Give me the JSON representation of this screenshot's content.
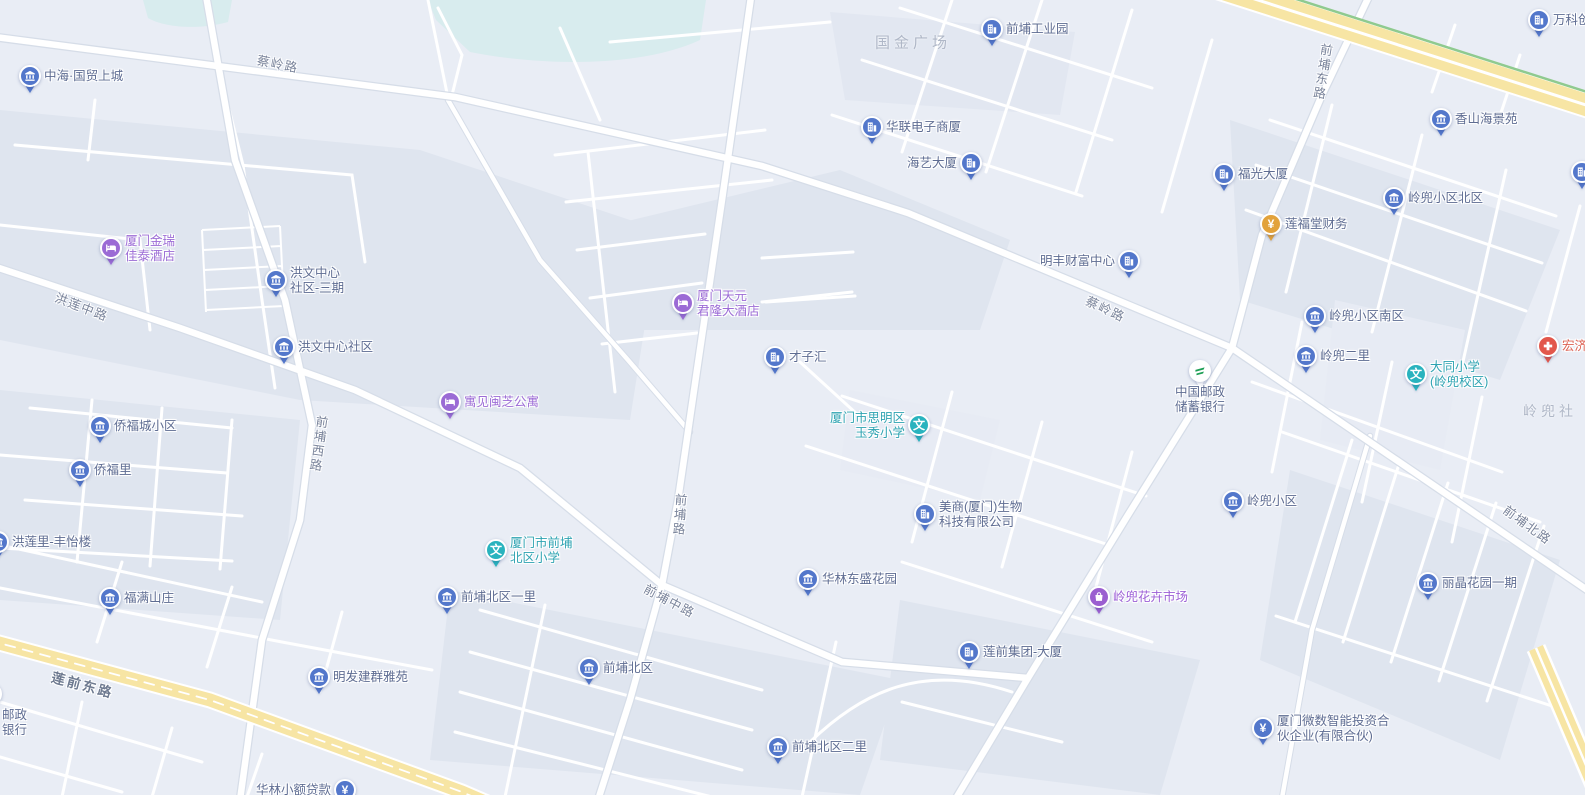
{
  "map": {
    "colors": {
      "background": "#E9EDF5",
      "block": "#DFE5EF",
      "block_light": "#E7EBF4",
      "water": "#D8ECEE",
      "road_fill": "#FFFFFF",
      "road_casing": "#D6DDE8",
      "highway_fill": "#F7E5A4",
      "highway_green": "#8FCA8F",
      "pin_blue": "#5377CB",
      "pin_teal": "#29B3BE",
      "pin_purple": "#9B6BD5",
      "pin_gold": "#E2A23B",
      "pin_red": "#E2574C",
      "post_green": "#1C9E54"
    },
    "poi_types": {
      "community": {
        "color": "#5377CB",
        "label_color": "#5E6C92",
        "icon": "estate-icon"
      },
      "office": {
        "color": "#5377CB",
        "label_color": "#5E6C92",
        "icon": "office-building-icon"
      },
      "school": {
        "color": "#29B3BE",
        "label_color": "#2EA3B2",
        "icon": "school-icon",
        "glyph_char": "文"
      },
      "hotel": {
        "color": "#9B6BD5",
        "label_color": "#9C6CD6",
        "icon": "hotel-bed-icon"
      },
      "market": {
        "color": "#9B5FD0",
        "label_color": "#9C5FD6",
        "icon": "shopping-bag-icon"
      },
      "finance": {
        "color": "#5377CB",
        "label_color": "#5E6C92",
        "icon": "yuan-icon",
        "glyph_char": "¥"
      },
      "finance_gold": {
        "color": "#E2A23B",
        "label_color": "#5E6C92",
        "icon": "yuan-icon",
        "glyph_char": "¥"
      },
      "hospital": {
        "color": "#E2574C",
        "label_color": "#DD6152",
        "icon": "medical-cross-icon"
      },
      "post": {
        "color": "#FFFFFF",
        "label_color": "#5E6C92",
        "icon": "china-post-icon"
      }
    },
    "pois": [
      {
        "type": "community",
        "x": 30,
        "y": 76,
        "side": "right",
        "lines": [
          "中海·国贸上城"
        ]
      },
      {
        "type": "community",
        "x": 276,
        "y": 280,
        "side": "right",
        "lines": [
          "洪文中心",
          "社区-三期"
        ]
      },
      {
        "type": "community",
        "x": 284,
        "y": 347,
        "side": "right",
        "lines": [
          "洪文中心社区"
        ]
      },
      {
        "type": "community",
        "x": 100,
        "y": 426,
        "side": "right",
        "lines": [
          "侨福城小区"
        ]
      },
      {
        "type": "community",
        "x": 80,
        "y": 470,
        "side": "right",
        "lines": [
          "侨福里"
        ]
      },
      {
        "type": "community",
        "x": -2,
        "y": 542,
        "side": "right",
        "lines": [
          "洪莲里-丰怡楼"
        ]
      },
      {
        "type": "community",
        "x": 110,
        "y": 598,
        "side": "right",
        "lines": [
          "福满山庄"
        ]
      },
      {
        "type": "community",
        "x": 447,
        "y": 597,
        "side": "right",
        "lines": [
          "前埔北区一里"
        ]
      },
      {
        "type": "community",
        "x": 589,
        "y": 668,
        "side": "right",
        "lines": [
          "前埔北区"
        ]
      },
      {
        "type": "community",
        "x": 778,
        "y": 747,
        "side": "right",
        "lines": [
          "前埔北区二里"
        ]
      },
      {
        "type": "community",
        "x": 808,
        "y": 579,
        "side": "right",
        "lines": [
          "华林东盛花园"
        ]
      },
      {
        "type": "community",
        "x": 319,
        "y": 677,
        "side": "right",
        "lines": [
          "明发建群雅苑"
        ]
      },
      {
        "type": "community",
        "x": 1441,
        "y": 119,
        "side": "right",
        "lines": [
          "香山海景苑"
        ]
      },
      {
        "type": "community",
        "x": 1394,
        "y": 198,
        "side": "right",
        "lines": [
          "岭兜小区北区"
        ]
      },
      {
        "type": "community",
        "x": 1315,
        "y": 316,
        "side": "right",
        "lines": [
          "岭兜小区南区"
        ]
      },
      {
        "type": "community",
        "x": 1306,
        "y": 356,
        "side": "right",
        "lines": [
          "岭兜二里"
        ]
      },
      {
        "type": "community",
        "x": 1233,
        "y": 501,
        "side": "right",
        "lines": [
          "岭兜小区"
        ]
      },
      {
        "type": "community",
        "x": 1428,
        "y": 583,
        "side": "right",
        "lines": [
          "丽晶花园一期"
        ]
      },
      {
        "type": "office",
        "x": 992,
        "y": 29,
        "side": "right",
        "lines": [
          "前埔工业园"
        ]
      },
      {
        "type": "office",
        "x": 872,
        "y": 127,
        "side": "right",
        "lines": [
          "华联电子商厦"
        ]
      },
      {
        "type": "office",
        "x": 971,
        "y": 163,
        "side": "left",
        "lines": [
          "海艺大厦"
        ]
      },
      {
        "type": "office",
        "x": 1224,
        "y": 174,
        "side": "right",
        "lines": [
          "福光大厦"
        ]
      },
      {
        "type": "office",
        "x": 1129,
        "y": 261,
        "side": "left",
        "lines": [
          "明丰财富中心"
        ]
      },
      {
        "type": "office",
        "x": 775,
        "y": 357,
        "side": "right",
        "lines": [
          "才子汇"
        ]
      },
      {
        "type": "office",
        "x": 925,
        "y": 514,
        "side": "right",
        "lines": [
          "美商(厦门)生物",
          "科技有限公司"
        ]
      },
      {
        "type": "office",
        "x": 969,
        "y": 652,
        "side": "right",
        "lines": [
          "莲前集团-大厦"
        ]
      },
      {
        "type": "office",
        "x": 1539,
        "y": 20,
        "side": "right",
        "lines": [
          "万科创"
        ]
      },
      {
        "type": "office",
        "x": 1582,
        "y": 172,
        "side": "right",
        "lines": []
      },
      {
        "type": "school",
        "x": 919,
        "y": 425,
        "side": "left",
        "lines": [
          "厦门市思明区",
          "玉秀小学"
        ]
      },
      {
        "type": "school",
        "x": 496,
        "y": 550,
        "side": "right",
        "lines": [
          "厦门市前埔",
          "北区小学"
        ]
      },
      {
        "type": "school",
        "x": 1416,
        "y": 374,
        "side": "right",
        "lines": [
          "大同小学",
          "(岭兜校区)"
        ]
      },
      {
        "type": "hotel",
        "x": 111,
        "y": 248,
        "side": "right",
        "lines": [
          "厦门金瑞",
          "佳泰酒店"
        ]
      },
      {
        "type": "hotel",
        "x": 683,
        "y": 303,
        "side": "right",
        "lines": [
          "厦门天元",
          "君隆大酒店"
        ]
      },
      {
        "type": "hotel",
        "x": 450,
        "y": 402,
        "side": "right",
        "lines": [
          "寓见闽芝公寓"
        ]
      },
      {
        "type": "market",
        "x": 1099,
        "y": 597,
        "side": "right",
        "lines": [
          "岭兜花卉市场"
        ]
      },
      {
        "type": "finance_gold",
        "x": 1271,
        "y": 224,
        "side": "right",
        "lines": [
          "莲福堂财务"
        ]
      },
      {
        "type": "finance",
        "x": 1263,
        "y": 728,
        "side": "right",
        "lines": [
          "厦门微数智能投资合",
          "伙企业(有限合伙)"
        ]
      },
      {
        "type": "finance",
        "x": 345,
        "y": 790,
        "side": "left",
        "lines": [
          "华林小额贷款"
        ]
      },
      {
        "type": "post",
        "x": 1200,
        "y": 371,
        "side": "below",
        "lines": [
          "中国邮政",
          "储蓄银行"
        ]
      },
      {
        "type": "post",
        "x": -9,
        "y": 694,
        "side": "below-left",
        "lines": [
          "邮政",
          "银行"
        ]
      },
      {
        "type": "hospital",
        "x": 1548,
        "y": 346,
        "side": "right",
        "lines": [
          "宏济"
        ]
      }
    ],
    "road_labels": [
      {
        "text": "蔡岭路",
        "x": 278,
        "y": 63,
        "angle": 11
      },
      {
        "text": "蔡岭路",
        "x": 1106,
        "y": 308,
        "angle": 25
      },
      {
        "text": "洪莲中路",
        "x": 82,
        "y": 306,
        "angle": 21
      },
      {
        "text": "前埔西路",
        "x": 318,
        "y": 444,
        "angle": 8,
        "vertical": true
      },
      {
        "text": "前埔东路",
        "x": 1322,
        "y": 72,
        "angle": 9,
        "vertical": true
      },
      {
        "text": "前埔路",
        "x": 679,
        "y": 515,
        "angle": 4,
        "vertical": true
      },
      {
        "text": "前埔中路",
        "x": 670,
        "y": 600,
        "angle": 28
      },
      {
        "text": "莲前东路",
        "x": 83,
        "y": 684,
        "angle": 15,
        "major": true
      },
      {
        "text": "前埔北路",
        "x": 1528,
        "y": 524,
        "angle": 36
      }
    ],
    "area_labels": [
      {
        "text": "国金广场",
        "x": 913,
        "y": 42,
        "size": 15
      },
      {
        "text": "岭兜社",
        "x": 1550,
        "y": 411,
        "size": 14
      }
    ]
  }
}
